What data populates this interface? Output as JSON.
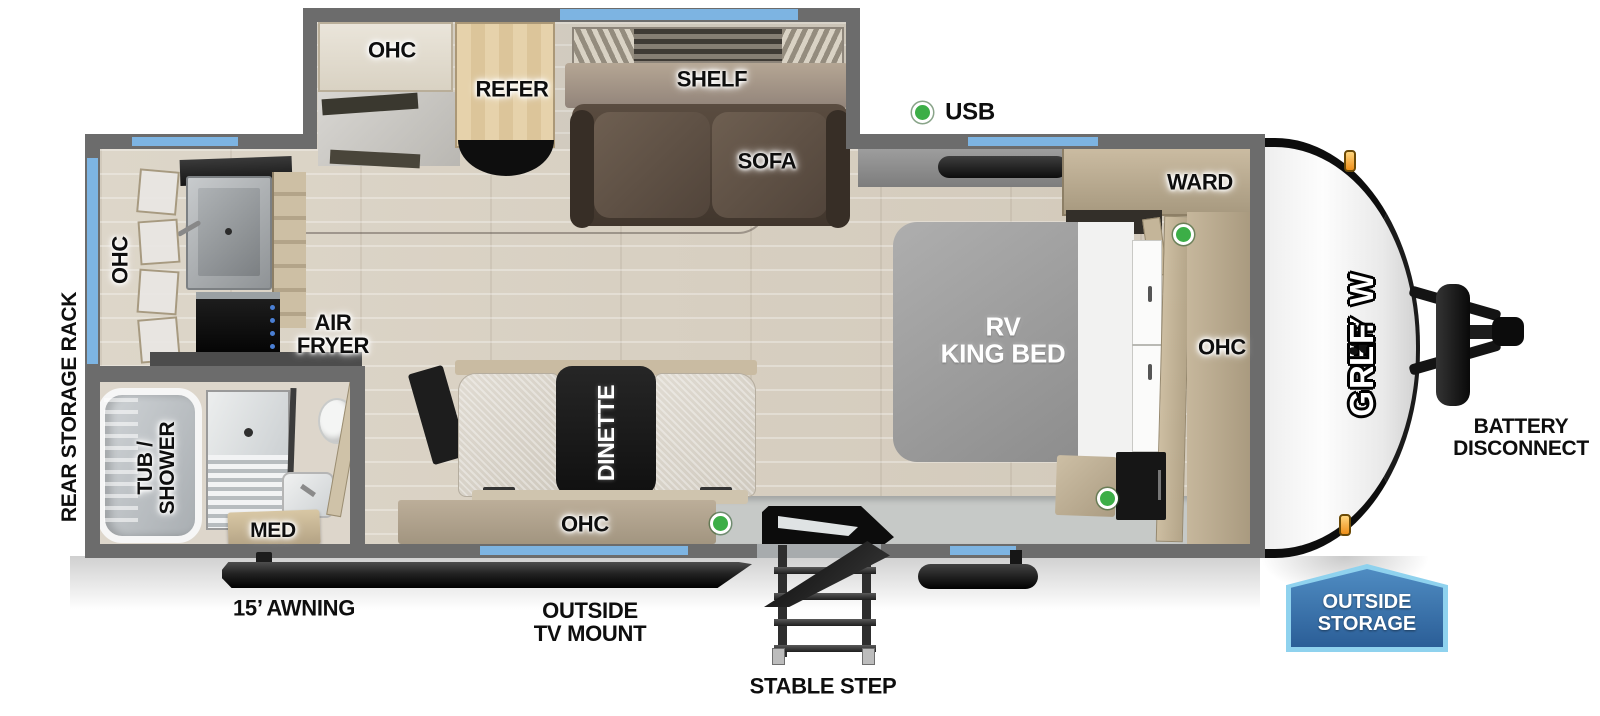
{
  "title": "Grey Wolf travel trailer floor plan",
  "brand": {
    "part1": "GREY W",
    "part2": "LF"
  },
  "labels": {
    "slideout_ohc": "OHC",
    "refer": "REFER",
    "shelf": "SHELF",
    "sofa": "SOFA",
    "usb": "USB",
    "ward": "WARD",
    "bedroom_ohc": "OHC",
    "rv_king_bed": "RV\nKING BED",
    "kitchen_ohc": "OHC",
    "air_fryer": "AIR\nFRYER",
    "rear_storage_rack": "REAR STORAGE RACK",
    "tub_shower": "TUB /\nSHOWER",
    "med": "MED",
    "dinette": "DINETTE",
    "dinette_ohc": "OHC",
    "awning": "15’ AWNING",
    "outside_tv_mount": "OUTSIDE\nTV MOUNT",
    "stable_step": "STABLE STEP",
    "battery_disconnect": "BATTERY\nDISCONNECT",
    "outside_storage": "OUTSIDE\nSTORAGE"
  },
  "colors": {
    "wall": "#6c6c6c",
    "window": "#7db4e2",
    "floor": "#d8d0c2",
    "wood": "#c6b79c",
    "sofa": "#5a4c40",
    "mattress": "#a3a3a3",
    "green_indicator": "#3cae47",
    "badge_blue": "#2b5e97",
    "badge_border": "#8fd2ee",
    "marker_light": "#ef8f1a"
  },
  "indicator_count": 4
}
